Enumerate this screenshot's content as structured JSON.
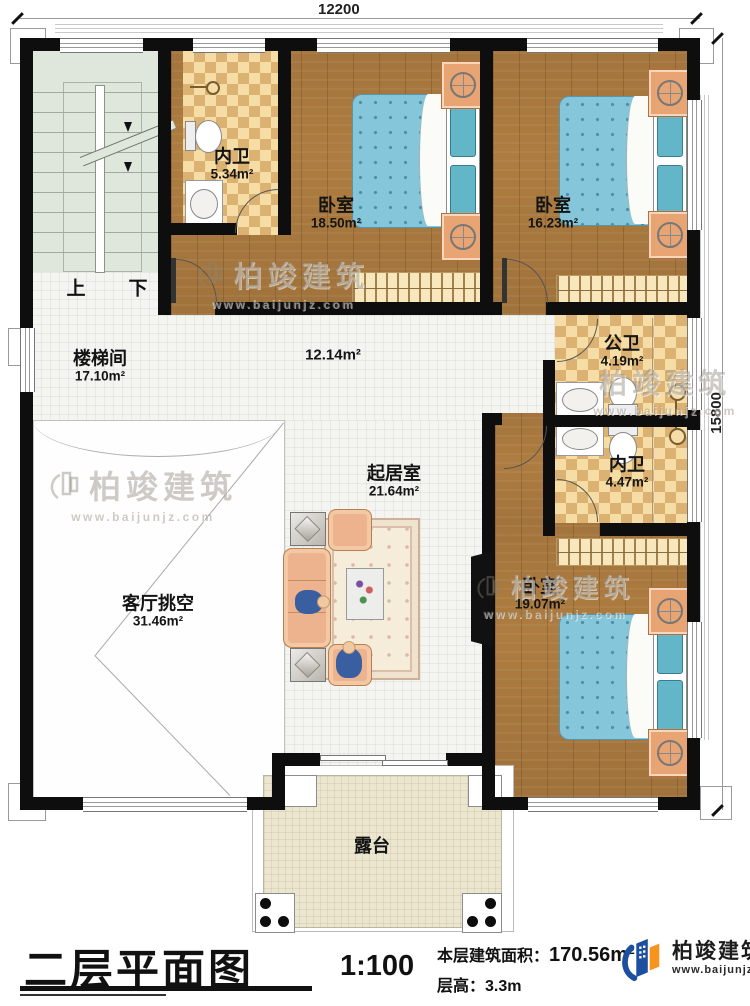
{
  "dimensions": {
    "top": "12200",
    "right": "15800"
  },
  "rooms": [
    {
      "id": "stairwell",
      "name": "楼梯间",
      "area": "17.10m²"
    },
    {
      "id": "bath-top",
      "name": "内卫",
      "area": "5.34m²"
    },
    {
      "id": "bedroom-1",
      "name": "卧室",
      "area": "18.50m²"
    },
    {
      "id": "bedroom-2",
      "name": "卧室",
      "area": "16.23m²"
    },
    {
      "id": "hallway",
      "name": "",
      "area": "12.14m²"
    },
    {
      "id": "public-bath",
      "name": "公卫",
      "area": "4.19m²"
    },
    {
      "id": "bath-inner",
      "name": "内卫",
      "area": "4.47m²"
    },
    {
      "id": "living",
      "name": "起居室",
      "area": "21.64m²"
    },
    {
      "id": "bedroom-3",
      "name": "卧室",
      "area": "19.07m²"
    },
    {
      "id": "void",
      "name": "客厅挑空",
      "area": "31.46m²"
    },
    {
      "id": "terrace",
      "name": "露台",
      "area": ""
    }
  ],
  "stairs": {
    "up": "上",
    "down": "下"
  },
  "watermark": {
    "name": "柏竣建筑",
    "url": "www.baijunjz.com"
  },
  "footer": {
    "title": "二层平面图",
    "scale": "1:100",
    "area_label": "本层建筑面积：",
    "area_value": "170.56m²",
    "height_label": "层高：",
    "height_value": "3.3m",
    "brand": "柏竣建筑",
    "brand_url": "www.baijunjz.com"
  }
}
